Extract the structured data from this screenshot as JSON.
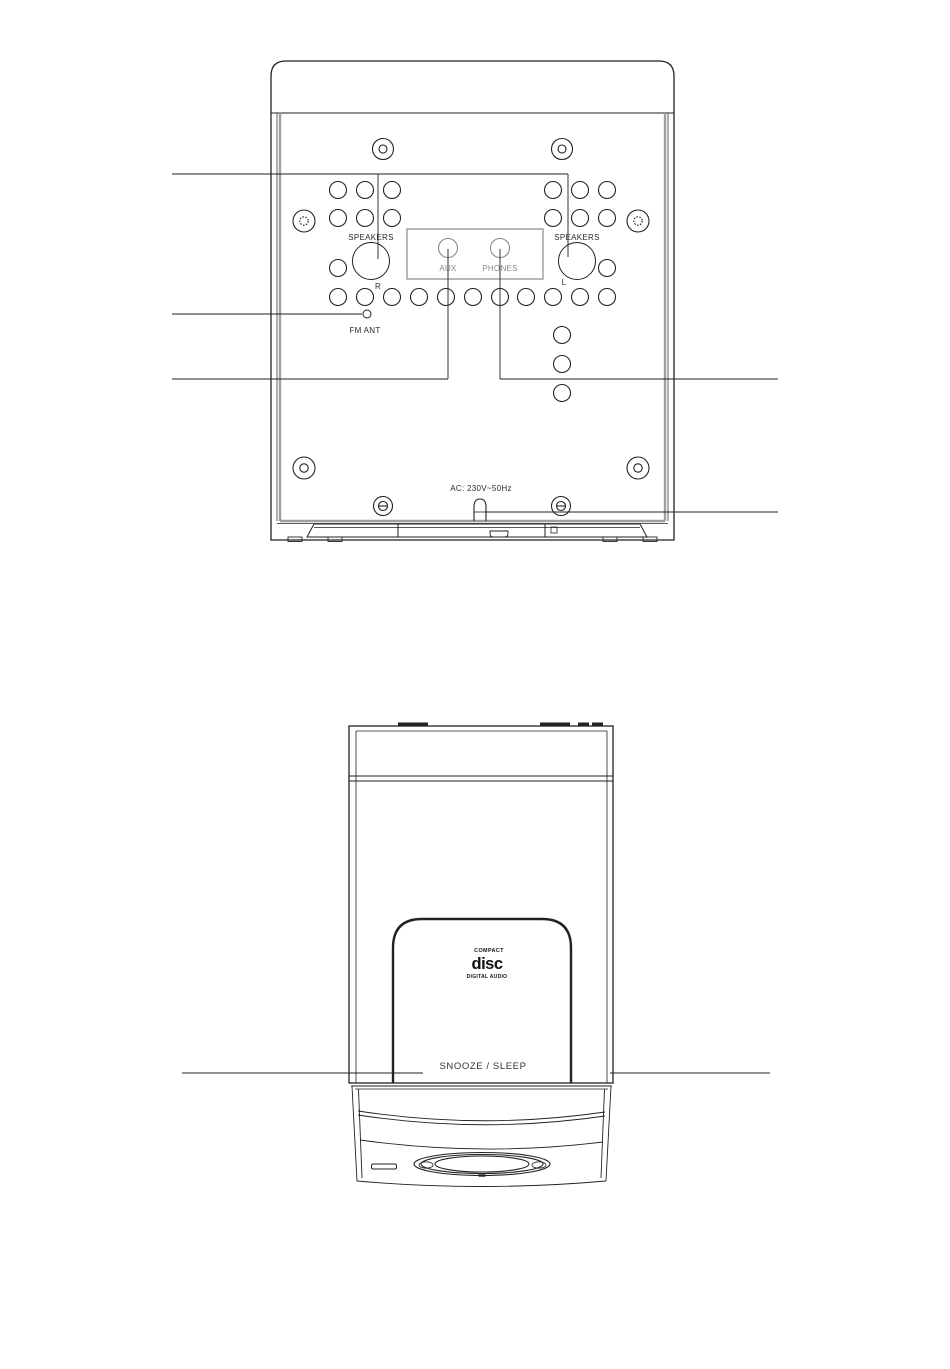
{
  "illustration": {
    "rear_view": {
      "speaker_right_terminal": {
        "label": "SPEAKERS",
        "channel": "R"
      },
      "speaker_left_terminal": {
        "label": "SPEAKERS",
        "channel": "L"
      },
      "jack_panel": {
        "aux": "AUX",
        "phones": "PHONES"
      },
      "fm_antenna_label": "FM ANT",
      "power_label": "AC: 230V~50Hz"
    },
    "top_view": {
      "snooze_sleep_label": "SNOOZE / SLEEP",
      "cd_logo": {
        "top": "COMPACT",
        "main": "disc",
        "bottom": "DIGITAL AUDIO"
      }
    },
    "colors": {
      "background": "#ffffff",
      "line": "#222222",
      "gray_line": "#9f9f9f",
      "jack_panel_gray": "#8a8a8a"
    }
  }
}
